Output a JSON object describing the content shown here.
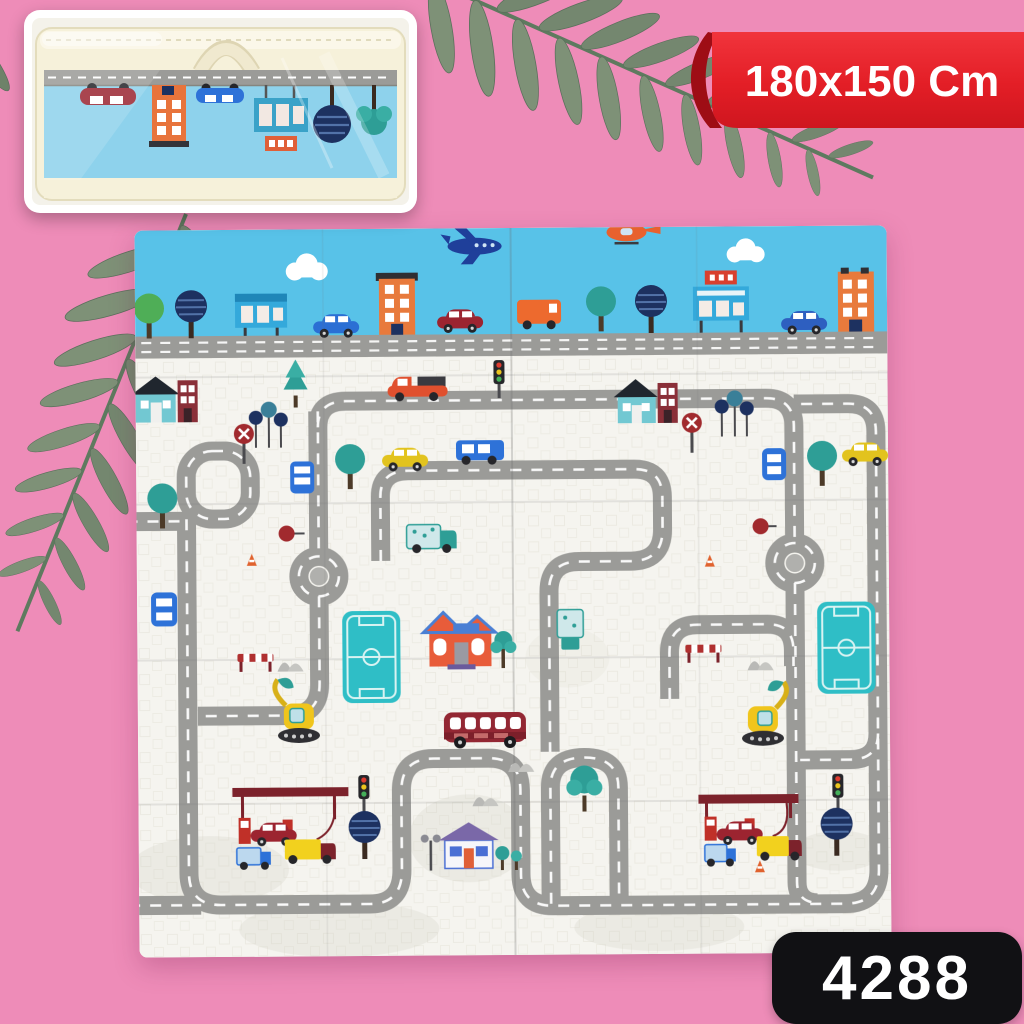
{
  "size_banner": {
    "label": "180x150 Cm"
  },
  "product_badge": {
    "code": "4288"
  },
  "palette": {
    "background_pink": "#ee8cb8",
    "ribbon_red": "#e31e26",
    "badge_black": "#111114",
    "sky_blue": "#58c2e8",
    "road_gray": "#9b9b98",
    "mat_cream": "#f5f4ef",
    "teal_accent": "#2fbec6",
    "leaf_green": "#74876f"
  }
}
